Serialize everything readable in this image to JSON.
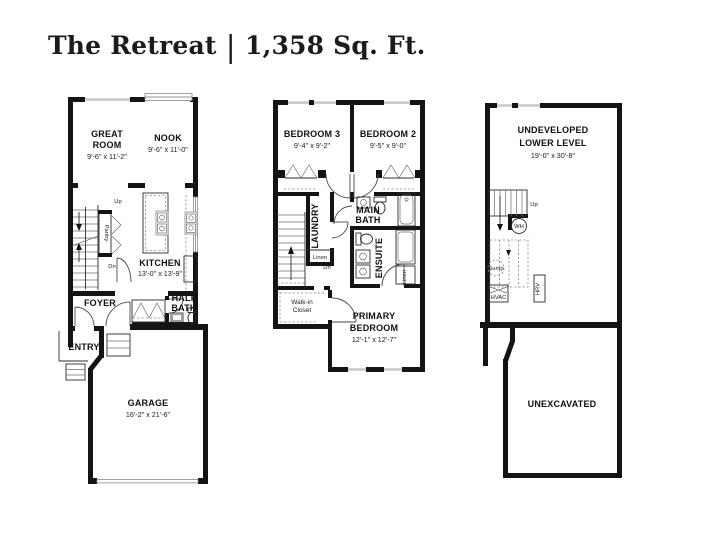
{
  "title": {
    "name": "The Retreat",
    "divider": "|",
    "area": "1,358 Sq. Ft."
  },
  "main_floor": {
    "great_room": {
      "line1": "GREAT",
      "line2": "ROOM",
      "dim": "9'-6\" x 11'-2\""
    },
    "nook": {
      "label": "NOOK",
      "dim": "9'-6\" x 11'-0\""
    },
    "kitchen": {
      "label": "KITCHEN",
      "dim": "13'-0\" x 13'-9\""
    },
    "pantry": {
      "label": "Pantry"
    },
    "stairs": {
      "up": "Up",
      "down": "Dn"
    },
    "foyer": {
      "label": "FOYER"
    },
    "half_bath": {
      "line1": "HALF",
      "line2": "BATH"
    },
    "entry": {
      "label": "ENTRY"
    },
    "garage": {
      "label": "GARAGE",
      "dim": "16'-2\" x 21'-6\""
    }
  },
  "upper_floor": {
    "bedroom3": {
      "label": "BEDROOM 3",
      "dim": "9'-4\" x 9'-2\""
    },
    "bedroom2": {
      "label": "BEDROOM 2",
      "dim": "9'-5\" x 9'-0\""
    },
    "laundry": {
      "label": "LAUNDRY"
    },
    "linen_hall": {
      "label": "Linen"
    },
    "stairs": {
      "down": "Dn"
    },
    "main_bath": {
      "line1": "MAIN",
      "line2": "BATH"
    },
    "ensuite": {
      "label": "ENSUITE"
    },
    "linen_ensuite": {
      "label": "Linen"
    },
    "walk_in_closet": {
      "line1": "Walk-in",
      "line2": "Closet"
    },
    "primary_bedroom": {
      "line1": "PRIMARY",
      "line2": "BEDROOM",
      "dim": "12'-1\" x 12'-7\""
    }
  },
  "lower_level": {
    "undeveloped": {
      "line1": "UNDEVELOPED",
      "line2": "LOWER LEVEL",
      "dim": "19'-0\" x 30'-8\""
    },
    "stairs": {
      "up": "Up"
    },
    "water_heater": {
      "label": "WH"
    },
    "sump": {
      "label": "Sump"
    },
    "hvac": {
      "label": "HVAC"
    },
    "hrv": {
      "label": "HRV"
    },
    "unexcavated": {
      "label": "UNEXCAVATED"
    }
  }
}
